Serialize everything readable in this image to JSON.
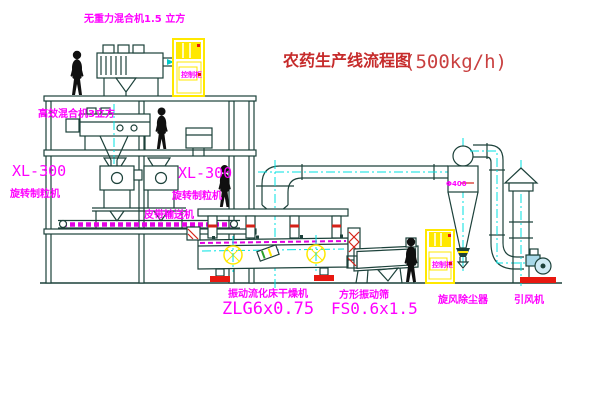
{
  "title": {
    "text": "农药生产线流程图",
    "capacity": "(500kg/h)"
  },
  "equipment": {
    "top_mixer": "无重力混合机1.5 立方",
    "mid_mixer": "高效混合机3立方",
    "granulator_left_model": "XL-300",
    "granulator_left_name": "旋转制粒机",
    "granulator_right_model": "XL-300",
    "granulator_right_name": "旋转制粒机",
    "belt_conveyor": "皮带输送机",
    "dryer_name": "振动流化床干燥机",
    "dryer_model": "ZLG6x0.75",
    "screen_name": "方形振动筛",
    "screen_model": "FS0.6x1.5",
    "cyclone_name": "旋风除尘器",
    "fan_name": "引风机",
    "cabinet_top_text": "控制柜",
    "cabinet_right_text": "控制柜",
    "cyclone_mark": "Φ400"
  },
  "colors": {
    "line": "#1c413a",
    "centerline": "#00e2e2",
    "label": "#ff00ff",
    "title": "#c62b2b",
    "highlight": "#ffe800",
    "accent": "#e81810"
  }
}
